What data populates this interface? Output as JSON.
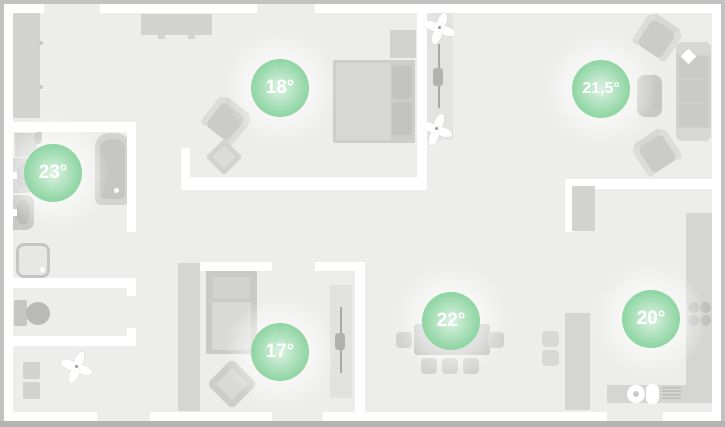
{
  "floorplan": {
    "badges": [
      {
        "room": "bedroom",
        "label": "18°"
      },
      {
        "room": "living-room",
        "label": "21,5°"
      },
      {
        "room": "bathroom",
        "label": "23°"
      },
      {
        "room": "kids-room",
        "label": "17°"
      },
      {
        "room": "dining-area",
        "label": "22°"
      },
      {
        "room": "kitchen",
        "label": "20°"
      }
    ]
  },
  "icons": {
    "plant": "pinwheel-flower",
    "sliding_door": "track-with-handle",
    "stove": "four-burners"
  },
  "colors": {
    "badge_green": "#12a73c",
    "wall": "#ffffff",
    "floor": "#ededeb",
    "frame": "#c2c2c1",
    "furniture_light": "#d5d5d4",
    "furniture_dark": "#c6c6c5"
  }
}
